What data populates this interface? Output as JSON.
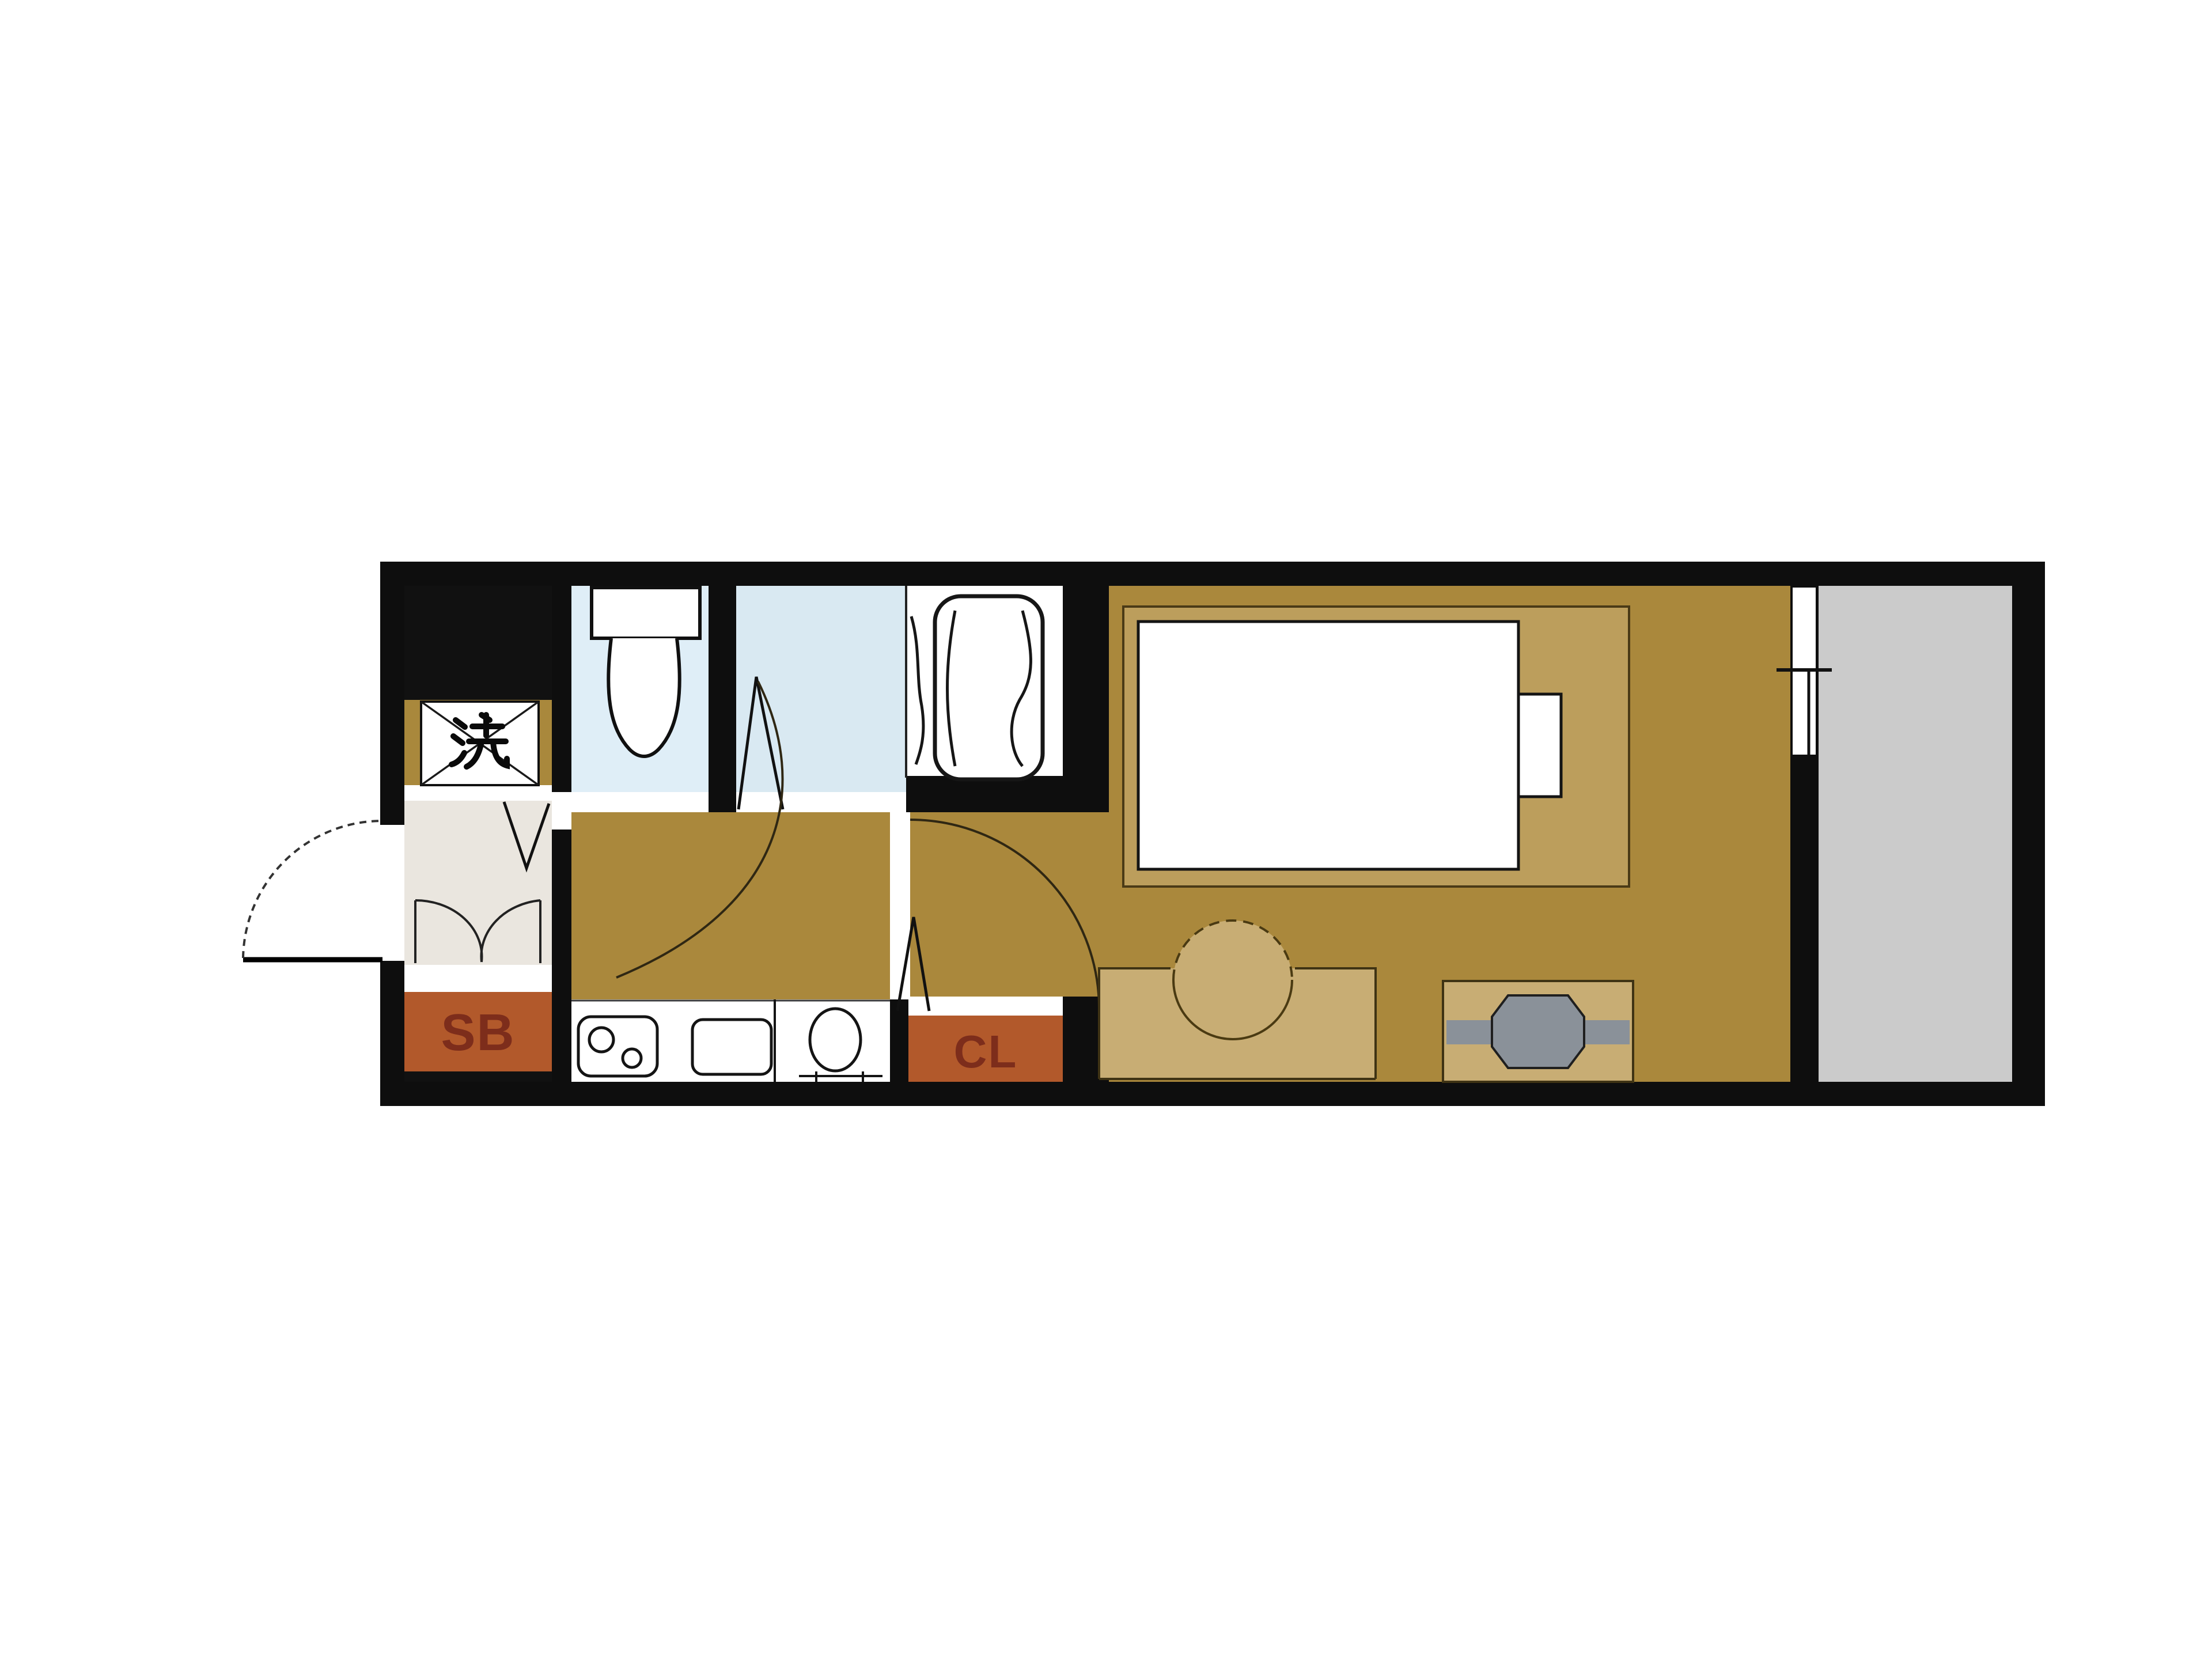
{
  "plan": {
    "type": "apartment-floor-plan",
    "labels": {
      "washer": "洗",
      "shoe_box": "SB",
      "closet": "CL"
    },
    "colors": {
      "wall": "#0e0e0e",
      "floor": "#aa883c",
      "washer_cell": "#a9883c",
      "genkan": "#eae6df",
      "toilet_floor": "#dfeef7",
      "bath_floor": "#d9e9f2",
      "tub_area": "#ffffff",
      "balcony": "#cbcbcb",
      "cabinet": "#b2592b",
      "cabinet_text": "#7d2d1b",
      "furniture": "#c8ad74",
      "bed_frame": "#bc9e5c",
      "mattress": "#ffffff",
      "tv_gray": "#8a9199",
      "fixture": "#ffffff",
      "black_void": "#111111"
    }
  }
}
